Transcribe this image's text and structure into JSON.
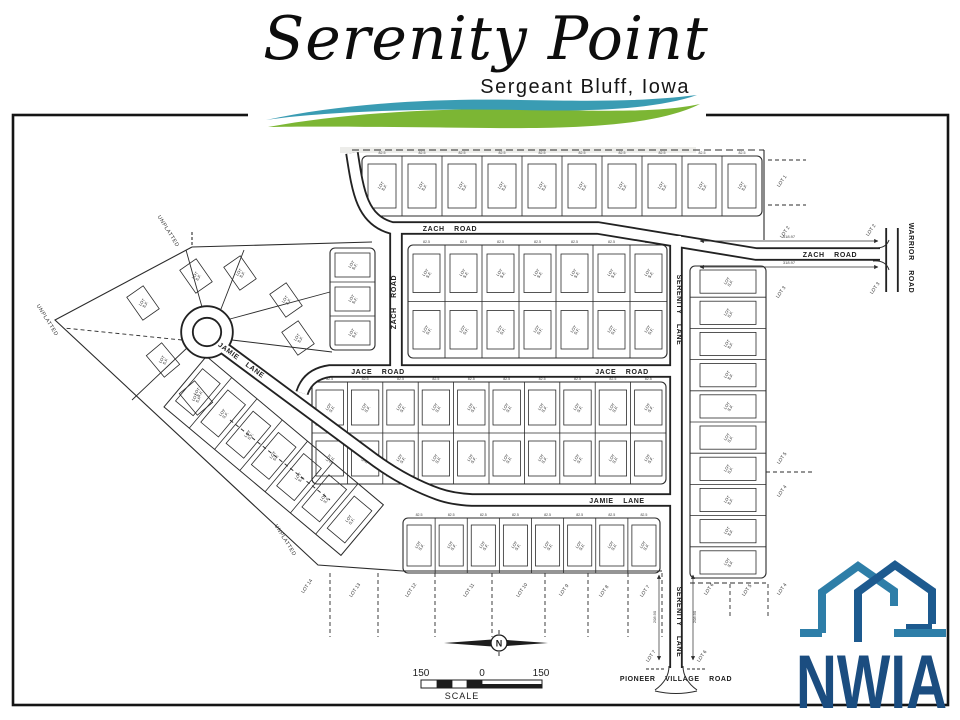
{
  "header": {
    "title": "Serenity Point",
    "subtitle": "Sergeant Bluff, Iowa"
  },
  "logo": {
    "text": "NWIA"
  },
  "colors": {
    "swoosh_teal": "#3a9cb3",
    "swoosh_green": "#7cb634",
    "logo_light_blue": "#2e7ea8",
    "logo_dark_blue": "#1d5a8f",
    "logo_text_color": "#1b4d80",
    "map_ink": "#2b2b2b"
  },
  "map": {
    "north_label": "N",
    "scale": {
      "left": "150",
      "mid": "0",
      "right": "150",
      "caption": "SCALE"
    },
    "lot_text_lines": [
      "LOT",
      "S.F."
    ],
    "dim_text": "82.5",
    "road_labels": [
      {
        "text": "ZACH ROAD",
        "x": 450,
        "y": 231,
        "r": 0
      },
      {
        "text": "ZACH ROAD",
        "x": 396,
        "y": 302,
        "r": -90
      },
      {
        "text": "ZACH ROAD",
        "x": 830,
        "y": 257,
        "r": 0
      },
      {
        "text": "WARRIOR ROAD",
        "x": 909,
        "y": 258,
        "r": 90
      },
      {
        "text": "SERENITY LANE",
        "x": 677,
        "y": 310,
        "r": 90
      },
      {
        "text": "JACE ROAD",
        "x": 378,
        "y": 374,
        "r": 0
      },
      {
        "text": "JACE ROAD",
        "x": 622,
        "y": 374,
        "r": 0
      },
      {
        "text": "JAMIE LANE",
        "x": 240,
        "y": 362,
        "r": 36
      },
      {
        "text": "JAMIE LANE",
        "x": 617,
        "y": 503,
        "r": 0
      },
      {
        "text": "SERENITY LANE",
        "x": 677,
        "y": 622,
        "r": 90
      },
      {
        "text": "PIONEER VILLAGE ROAD",
        "x": 676,
        "y": 681,
        "r": 0
      }
    ],
    "area_labels": [
      {
        "text": "UNPLATTED",
        "x": 167,
        "y": 232,
        "r": 58
      },
      {
        "text": "UNPLATTED",
        "x": 46,
        "y": 321,
        "r": 58
      },
      {
        "text": "UNPLATTED",
        "x": 284,
        "y": 541,
        "r": 58
      }
    ],
    "neighbor_lot_labels": [
      {
        "text": "LOT 1",
        "x": 783,
        "y": 182,
        "r": -55
      },
      {
        "text": "LOT 2",
        "x": 786,
        "y": 233,
        "r": -55
      },
      {
        "text": "LOT 2",
        "x": 872,
        "y": 231,
        "r": -55
      },
      {
        "text": "LOT 3",
        "x": 782,
        "y": 293,
        "r": -55
      },
      {
        "text": "LOT 3",
        "x": 876,
        "y": 289,
        "r": -55
      },
      {
        "text": "LOT 5",
        "x": 783,
        "y": 459,
        "r": -55
      },
      {
        "text": "LOT 4",
        "x": 783,
        "y": 492,
        "r": -55
      },
      {
        "text": "LOT 14",
        "x": 308,
        "y": 587,
        "r": -55
      },
      {
        "text": "LOT 13",
        "x": 356,
        "y": 591,
        "r": -55
      },
      {
        "text": "LOT 12",
        "x": 412,
        "y": 591,
        "r": -55
      },
      {
        "text": "LOT 11",
        "x": 470,
        "y": 591,
        "r": -55
      },
      {
        "text": "LOT 10",
        "x": 523,
        "y": 591,
        "r": -55
      },
      {
        "text": "LOT 9",
        "x": 565,
        "y": 591,
        "r": -55
      },
      {
        "text": "LOT 8",
        "x": 605,
        "y": 592,
        "r": -55
      },
      {
        "text": "LOT 7",
        "x": 646,
        "y": 592,
        "r": -55
      },
      {
        "text": "LOT 6",
        "x": 710,
        "y": 590,
        "r": -55
      },
      {
        "text": "LOT 5",
        "x": 748,
        "y": 591,
        "r": -55
      },
      {
        "text": "LOT 4",
        "x": 783,
        "y": 590,
        "r": -55
      },
      {
        "text": "LOT 7",
        "x": 652,
        "y": 657,
        "r": -55
      },
      {
        "text": "LOT 6",
        "x": 703,
        "y": 657,
        "r": -55
      }
    ],
    "dim_labels": [
      {
        "text": "318.97",
        "x": 789,
        "y": 238,
        "r": 0
      },
      {
        "text": "318.97",
        "x": 789,
        "y": 264,
        "r": 0
      },
      {
        "text": "208.90",
        "x": 656,
        "y": 617,
        "r": -90
      },
      {
        "text": "208.90",
        "x": 696,
        "y": 617,
        "r": -90
      }
    ],
    "blocks": [
      {
        "x": 362,
        "y": 156,
        "w": 400,
        "h": 60,
        "cols": 10,
        "rows": 1,
        "ix": 6,
        "iy": 8,
        "dims": true
      },
      {
        "x": 408,
        "y": 245,
        "w": 259,
        "h": 113,
        "cols": 7,
        "rows": 2,
        "ix": 5,
        "iy": 9,
        "dims": true
      },
      {
        "x": 330,
        "y": 248,
        "w": 45,
        "h": 102,
        "cols": 1,
        "rows": 3,
        "ix": 5,
        "iy": 5,
        "dims": false
      },
      {
        "x": 312,
        "y": 382,
        "w": 354,
        "h": 102,
        "cols": 10,
        "rows": 2,
        "ix": 4,
        "iy": 8,
        "dims": true
      },
      {
        "x": 403,
        "y": 518,
        "w": 257,
        "h": 55,
        "cols": 8,
        "rows": 1,
        "ix": 4,
        "iy": 7,
        "dims": true
      },
      {
        "x": 690,
        "y": 266,
        "w": 76,
        "h": 312,
        "cols": 1,
        "rows": 10,
        "ix": 10,
        "iy": 4,
        "dims": false
      }
    ],
    "free_lots": [
      [
        143,
        303,
        -35
      ],
      [
        196,
        276,
        -35
      ],
      [
        240,
        273,
        -35
      ],
      [
        286,
        300,
        -35
      ],
      [
        298,
        338,
        -35
      ],
      [
        163,
        360,
        -40
      ],
      [
        196,
        398,
        -40
      ]
    ],
    "diag_band": {
      "tx": 200,
      "ty": 364,
      "rot": 40,
      "count": 7,
      "cw": 33,
      "cy": -10,
      "ch": 66
    }
  }
}
